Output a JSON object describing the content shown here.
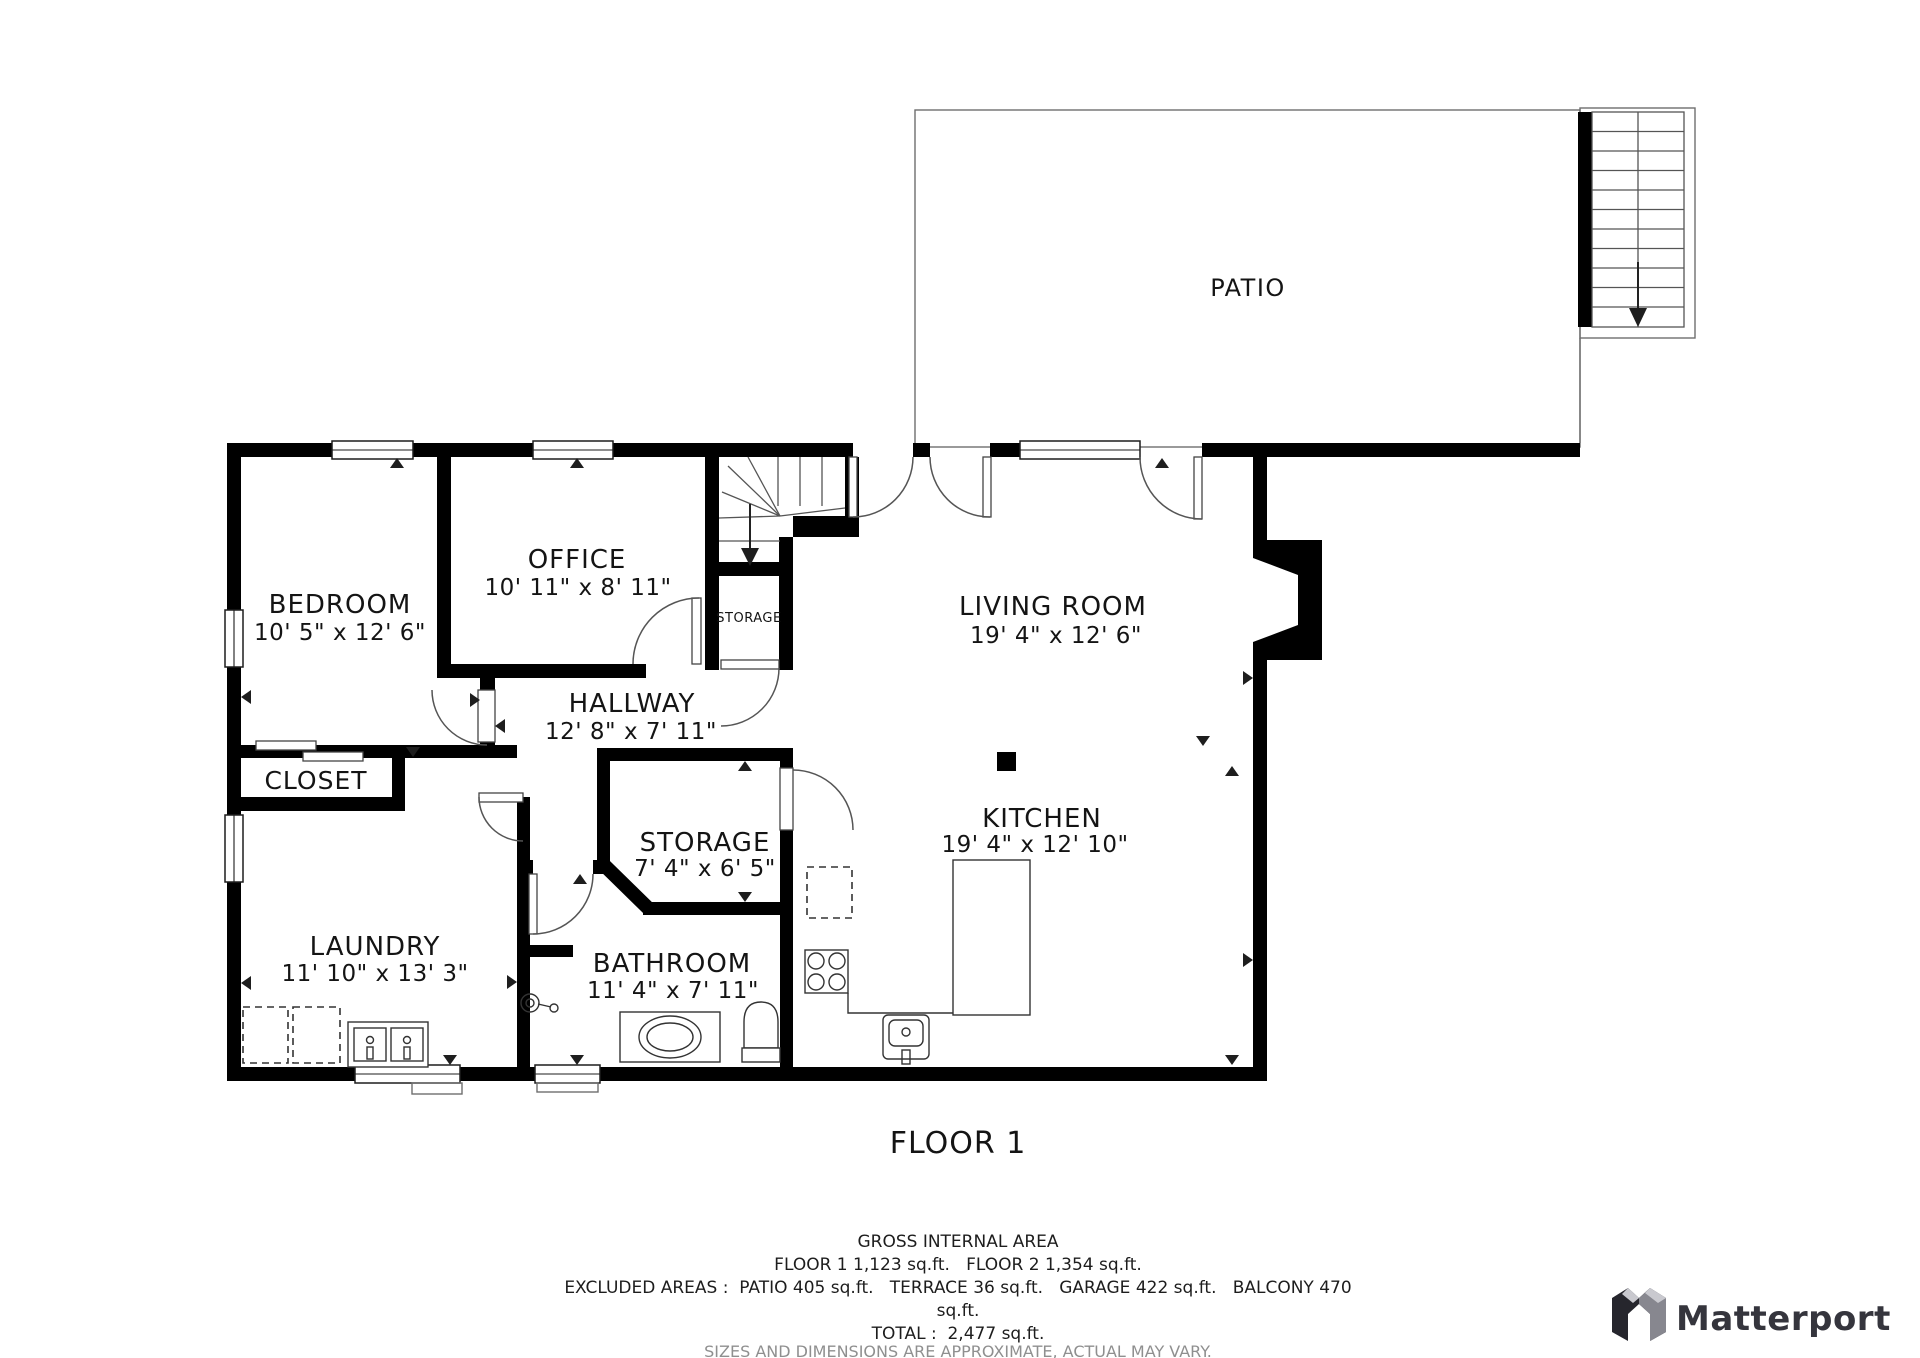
{
  "plan": {
    "title": "FLOOR 1",
    "rooms": [
      {
        "name": "PATIO",
        "dims": ""
      },
      {
        "name": "BEDROOM",
        "dims": "10' 5\" x 12' 6\""
      },
      {
        "name": "OFFICE",
        "dims": "10' 11\" x 8' 11\""
      },
      {
        "name": "STORAGE",
        "dims": ""
      },
      {
        "name": "LIVING ROOM",
        "dims": "19' 4\" x 12' 6\""
      },
      {
        "name": "HALLWAY",
        "dims": "12' 8\" x 7' 11\""
      },
      {
        "name": "CLOSET",
        "dims": ""
      },
      {
        "name": "STORAGE",
        "dims": "7' 4\" x 6' 5\""
      },
      {
        "name": "KITCHEN",
        "dims": "19' 4\" x 12' 10\""
      },
      {
        "name": "LAUNDRY",
        "dims": "11' 10\" x 13' 3\""
      },
      {
        "name": "BATHROOM",
        "dims": "11' 4\" x 7' 11\""
      }
    ],
    "footer": {
      "heading": "GROSS INTERNAL AREA",
      "line_floors": "FLOOR 1 1,123 sq.ft.   FLOOR 2 1,354 sq.ft.",
      "line_excluded": "EXCLUDED AREAS :  PATIO 405 sq.ft.   TERRACE 36 sq.ft.   GARAGE 422 sq.ft.   BALCONY 470",
      "line_excluded_wrap": "sq.ft.",
      "line_total": "TOTAL :  2,477 sq.ft.",
      "disclaimer": "SIZES AND DIMENSIONS ARE APPROXIMATE, ACTUAL MAY VARY."
    },
    "brand": "Matterport"
  }
}
